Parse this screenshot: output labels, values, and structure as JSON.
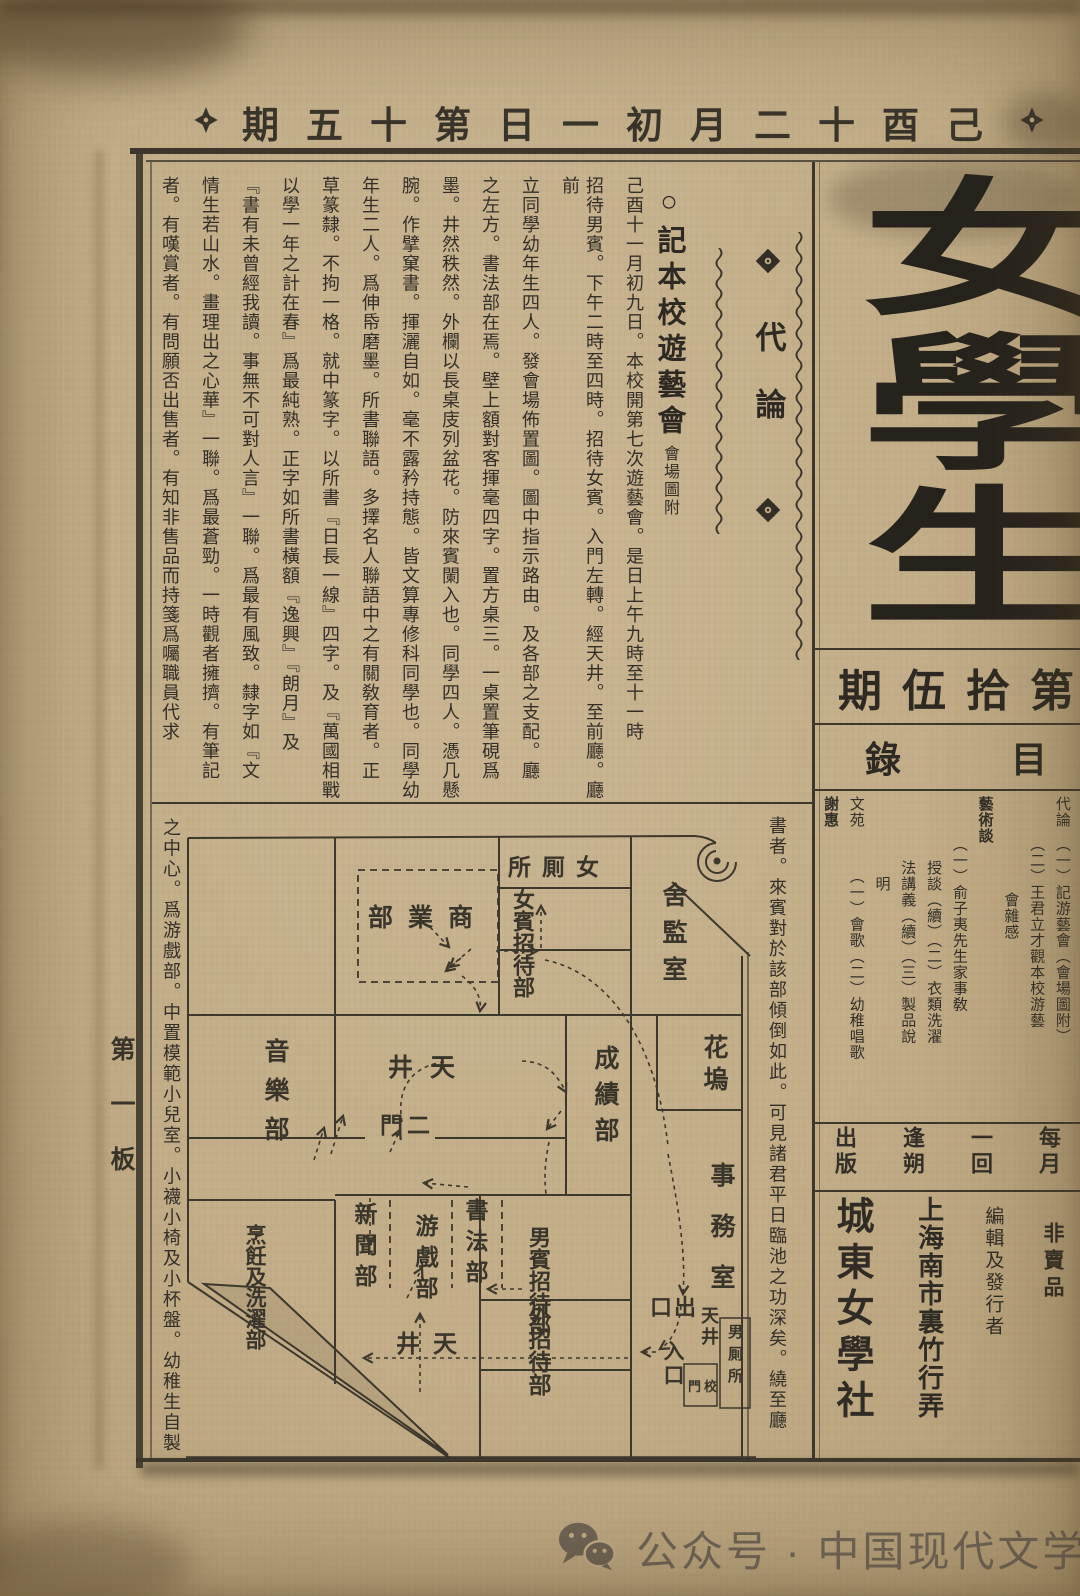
{
  "header": {
    "issue_date_display": "期五十第日一初月二十酉己"
  },
  "masthead": {
    "title": "女學生"
  },
  "issue": {
    "number_display": "期伍拾第"
  },
  "contents": {
    "title_display": "錄目"
  },
  "toc": {
    "columns": [
      "代論　（一）記游藝會（會場圖附）",
      "　　　（二）王君立才觀本校游藝",
      "　　　　　　會雜感",
      "藝術談",
      "　　　（一）俞子夷先生家事敎",
      "　　　　授談（續）（二）衣類洗濯",
      "　　　　法講義（續）（三）製品說",
      "　　　　　明",
      "文苑　　　（一）會歌（二）幼稚唱歌",
      "謝惠"
    ]
  },
  "publication": {
    "schedule": [
      "每月",
      "一回",
      "逢朔",
      "出版"
    ],
    "info": [
      "非賣品",
      "編輯及發行者",
      "上海南市裏竹行弄",
      "城東女學社"
    ]
  },
  "section": {
    "label": "代論"
  },
  "article": {
    "title": "○記本校遊藝會",
    "subtitle": "會場圖附",
    "columns": [
      "己酉十一月初九日。本校開第七次遊藝會。是日上午九時至十一時",
      "招待男賓。下午二時至四時。招待女賓。入門左轉。經天井。至前廳。廳前",
      "立同學幼年生四人。發會場佈置圖。圖中指示路由。及各部之支配。廳",
      "之左方。書法部在焉。壁上額對客揮毫四字。置方桌三。一桌置筆硯爲",
      "墨。井然秩然。外欄以長桌庋列盆花。防來賓闌入也。同學四人。憑几懸",
      "腕。作擘窠書。揮灑自如。毫不露矜持態。皆文算專修科同學也。同學幼",
      "年生二人。爲伸帋磨墨。所書聯語。多擇名人聯語中之有關敎育者。正",
      "草篆隸。不拘一格。就中篆字。以所書『日長一線』四字。及『萬國相戰",
      "以學一年之計在春』爲最純熟。正字如所書橫額『逸興』『朗月』及",
      "『書有未曾經我讀。事無不可對人言』一聯。爲最有風致。隸字如『文",
      "情生若山水。畫理出之心華』一聯。爲最蒼勁。一時觀者擁擠。有筆記",
      "者。有嘆賞者。有問願否出售者。有知非售品而持箋爲囑職員代求"
    ],
    "continuation_right": "書者。來賓對於該部傾倒如此。可見諸君平日臨池之功深矣。繞至廳",
    "continuation_left": "之中心。爲游戲部。中置模範小兒室。小襪小椅及小杯盤。幼稚生自製"
  },
  "map": {
    "rooms": {
      "commerce": "部業商",
      "toilet_f": "所厠女",
      "reception_f": "女賓招待部",
      "matron": "舍監室",
      "music": "音樂部",
      "courtyard2": "井天",
      "gate2": "門二",
      "grades": "成績部",
      "flower": "花塢",
      "cooking": "烹飪及洗濯部",
      "news": "新聞部",
      "games": "游戲部",
      "calligraphy": "書法部",
      "reception_m": "男賓招待部",
      "office": "事務室",
      "courtyard_b": "井天",
      "reception_ext": "外招待部",
      "exit": "口出",
      "courtyard_r": "天井",
      "entrance": "入口",
      "school_gate": "門校",
      "toilet_m": "男厠所"
    }
  },
  "margin": {
    "page_label": "第一板"
  },
  "footer": {
    "text": "公众号 · 中国现代文学研究丛刊"
  }
}
